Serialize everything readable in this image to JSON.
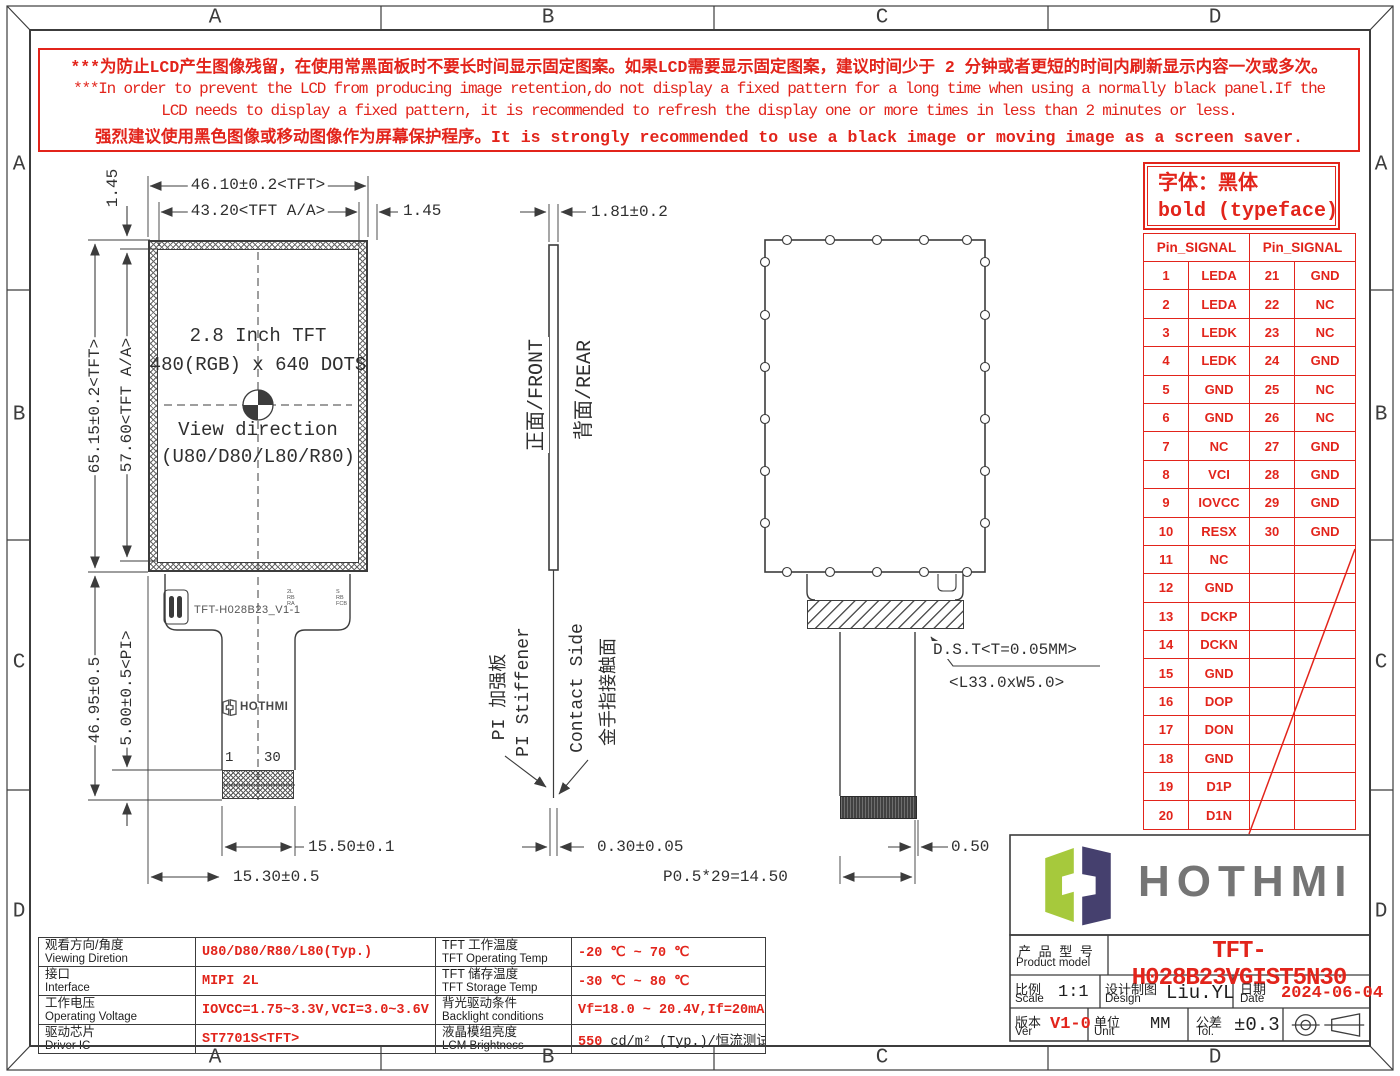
{
  "colors": {
    "accent_red": "#e2241b",
    "line": "#3c3c3c",
    "logo_green": "#a6c93c",
    "logo_navy": "#45406e"
  },
  "frame": {
    "letters": [
      "A",
      "B",
      "C",
      "D"
    ]
  },
  "warning": {
    "l1": "***为防止LCD产生图像残留，在使用常黑面板时不要长时间显示固定图案。如果LCD需要显示固定图案，建议时间少于 2 分钟或者更短的时间内刷新显示内容一次或多次。",
    "l2": "***In order to prevent the LCD from producing image retention,do not display a fixed pattern for a long time when using a normally black panel.If the",
    "l3": "LCD needs to display a fixed pattern,  it is recommended to refresh the display one or more times in less than 2 minutes or less.",
    "l4": "强烈建议使用黑色图像或移动图像作为屏幕保护程序。It is strongly recommended to use a black image or moving image as a screen saver."
  },
  "typeface_note": {
    "l1": "字体：黑体",
    "l2": "bold (typeface)"
  },
  "pin_table": {
    "header_left": "Pin_SIGNAL",
    "header_right": "Pin_SIGNAL",
    "rows": [
      {
        "p1": "1",
        "s1": "LEDA",
        "p2": "21",
        "s2": "GND"
      },
      {
        "p1": "2",
        "s1": "LEDA",
        "p2": "22",
        "s2": "NC"
      },
      {
        "p1": "3",
        "s1": "LEDK",
        "p2": "23",
        "s2": "NC"
      },
      {
        "p1": "4",
        "s1": "LEDK",
        "p2": "24",
        "s2": "GND"
      },
      {
        "p1": "5",
        "s1": "GND",
        "p2": "25",
        "s2": "NC"
      },
      {
        "p1": "6",
        "s1": "GND",
        "p2": "26",
        "s2": "NC"
      },
      {
        "p1": "7",
        "s1": "NC",
        "p2": "27",
        "s2": "GND"
      },
      {
        "p1": "8",
        "s1": "VCI",
        "p2": "28",
        "s2": "GND"
      },
      {
        "p1": "9",
        "s1": "IOVCC",
        "p2": "29",
        "s2": "GND"
      },
      {
        "p1": "10",
        "s1": "RESX",
        "p2": "30",
        "s2": "GND"
      },
      {
        "p1": "11",
        "s1": "NC",
        "p2": "",
        "s2": ""
      },
      {
        "p1": "12",
        "s1": "GND",
        "p2": "",
        "s2": ""
      },
      {
        "p1": "13",
        "s1": "DCKP",
        "p2": "",
        "s2": ""
      },
      {
        "p1": "14",
        "s1": "DCKN",
        "p2": "",
        "s2": ""
      },
      {
        "p1": "15",
        "s1": "GND",
        "p2": "",
        "s2": ""
      },
      {
        "p1": "16",
        "s1": "DOP",
        "p2": "",
        "s2": ""
      },
      {
        "p1": "17",
        "s1": "DON",
        "p2": "",
        "s2": ""
      },
      {
        "p1": "18",
        "s1": "GND",
        "p2": "",
        "s2": ""
      },
      {
        "p1": "19",
        "s1": "D1P",
        "p2": "",
        "s2": ""
      },
      {
        "p1": "20",
        "s1": "D1N",
        "p2": "",
        "s2": ""
      }
    ]
  },
  "front_view": {
    "center": {
      "l1": "2.8 Inch TFT",
      "l2": "480(RGB) x 640 DOTS",
      "l3": "View direction",
      "l4": "(U80/D80/L80/R80)"
    },
    "fpc_label": "TFT-H028B23_V1-1",
    "fpc_marks1": "2L\nRB\nRA",
    "fpc_marks2": "S\nRB\nFCB",
    "pin_first": "1",
    "pin_last": "30",
    "mini_logo": "HOTHMI",
    "dims": {
      "width_tft": "46.10±0.2<TFT>",
      "width_aa": "43.20<TFT A/A>",
      "margin_right": "1.45",
      "margin_top": "1.45",
      "height_aa": "57.60<TFT A/A>",
      "height_tft": "65.15±0.2<TFT>",
      "pi": "5.00±0.5<PI>",
      "tail": "46.95±0.5",
      "conn_width": "15.50±0.1",
      "conn_offset": "15.30±0.5"
    }
  },
  "side_view": {
    "front_label": "正面/FRONT",
    "rear_label": "背面/REAR",
    "pi_cn": "PI 加强板",
    "pi_en": "PI Stiffener",
    "contact_en": "Contact Side",
    "contact_cn": "金手指接触面",
    "dims": {
      "thickness": "1.81±0.2",
      "fpc": "0.30±0.05"
    }
  },
  "rear_view": {
    "dst": "D.S.T<T=0.05MM>",
    "lw": "<L33.0xW5.0>",
    "dims": {
      "edge": "0.50",
      "pitch": "P0.5*29=14.50"
    }
  },
  "logo": {
    "text": "HOTHMI"
  },
  "title_block": {
    "product_cn": "产 品 型 号",
    "product_en": "Product model",
    "product_model": "TFT-H028B23VGIST5N30",
    "scale_cn": "比例",
    "scale_en": "Scale",
    "scale": "1:1",
    "design_cn": "设计制图",
    "design_en": "Design",
    "designer": "Liu.YL",
    "date_cn": "日期",
    "date_en": "Date",
    "date": "2024-06-04",
    "ver_cn": "版本",
    "ver_en": "Ver",
    "ver": "V1-0",
    "unit_cn": "单位",
    "unit_en": "Unit",
    "unit": "MM",
    "tol_cn": "公差",
    "tol_en": "Tol.",
    "tol": "±0.3"
  },
  "spec_table": {
    "rows": [
      {
        "l1cn": "观看方向/角度",
        "l1en": "Viewing Diretion",
        "v1": "U80/D80/R80/L80(Typ.)",
        "l2cn": "TFT 工作温度",
        "l2en": "TFT Operating Temp",
        "v2": "-20 ℃ ~ 70 ℃",
        "v2b": ""
      },
      {
        "l1cn": "接口",
        "l1en": "Interface",
        "v1": "MIPI 2L",
        "l2cn": "TFT 储存温度",
        "l2en": "TFT Storage Temp",
        "v2": "-30 ℃ ~ 80 ℃",
        "v2b": ""
      },
      {
        "l1cn": "工作电压",
        "l1en": "Operating Voltage",
        "v1": "IOVCC=1.75~3.3V,VCI=3.0~3.6V",
        "l2cn": "背光驱动条件",
        "l2en": "Backlight conditions",
        "v2": "Vf=18.0 ~ 20.4V,If=20mA",
        "v2b": ""
      },
      {
        "l1cn": "驱动芯片",
        "l1en": "Driver IC",
        "v1": "ST7701S<TFT>",
        "l2cn": "液晶模组亮度",
        "l2en": "LCM Brightness",
        "v2": "550",
        "v2b": " cd/m² (Typ.)/恒流测试"
      }
    ]
  }
}
